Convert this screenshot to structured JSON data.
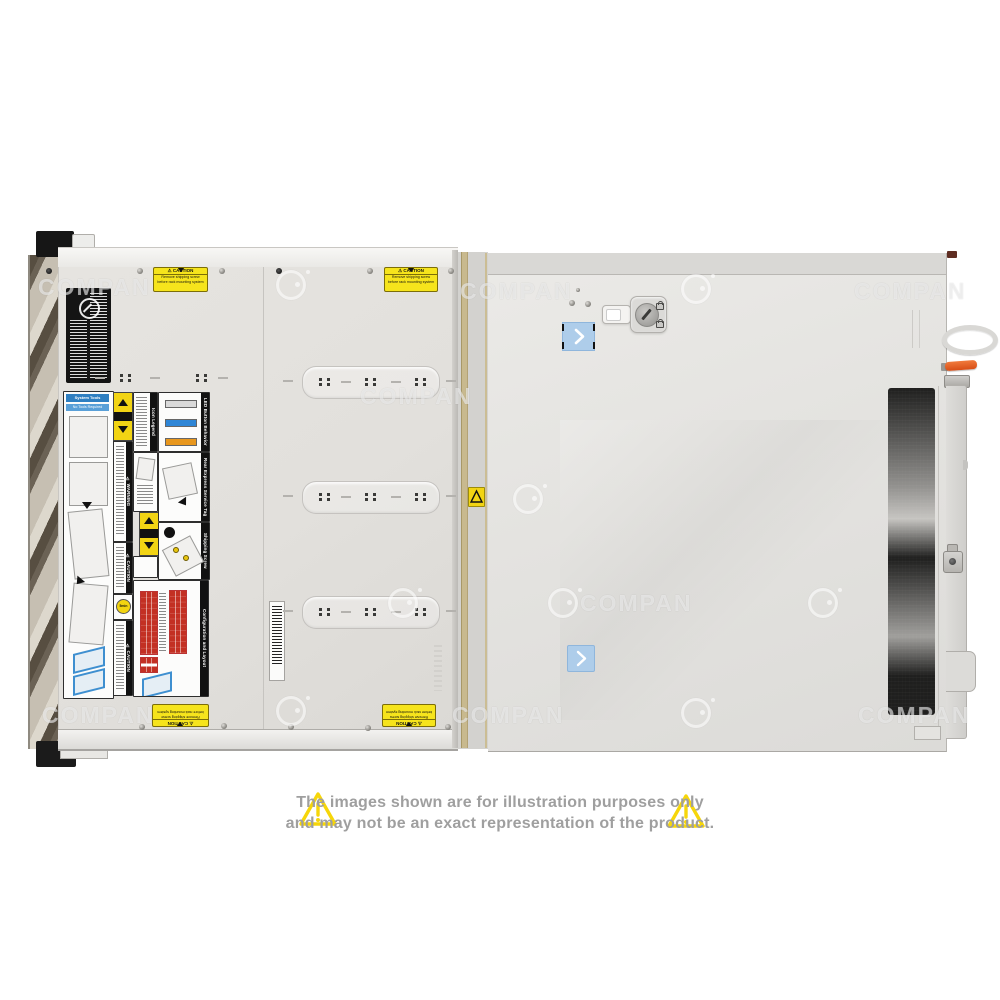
{
  "watermark": {
    "text": "COMPAN"
  },
  "stickers": {
    "caution": {
      "title": "⚠ CAUTION",
      "line1": "Remove shipping screw",
      "line2": "before rack mounting system"
    }
  },
  "service_labels": {
    "system_tools": "System Tools",
    "no_tools": "No Tools Required",
    "warning": "⚠ WARNING",
    "caution": "⚠ CAUTION",
    "five_min": "5min",
    "icon_legend": "Icon Legend",
    "led_button": "LED Button Behavior",
    "rear_tag": "Rear Express Service Tag",
    "shipping": "Shipping Screw Removal",
    "config": "Configuration and Layout"
  },
  "disclaimer": {
    "line1": "The images shown are for illustration purposes only",
    "line2": "and may not be an exact representation of the product."
  },
  "colors": {
    "caution_yellow": "#f6e41c",
    "sticker_blue": "#aecdea",
    "led_blue": "#2f86d6",
    "led_orange": "#e8971d",
    "handle_orange": "#d84e16",
    "config_red": "#c33023",
    "disclaimer_gray": "#9f9f9f",
    "triangle_yellow": "#f6d60a"
  }
}
